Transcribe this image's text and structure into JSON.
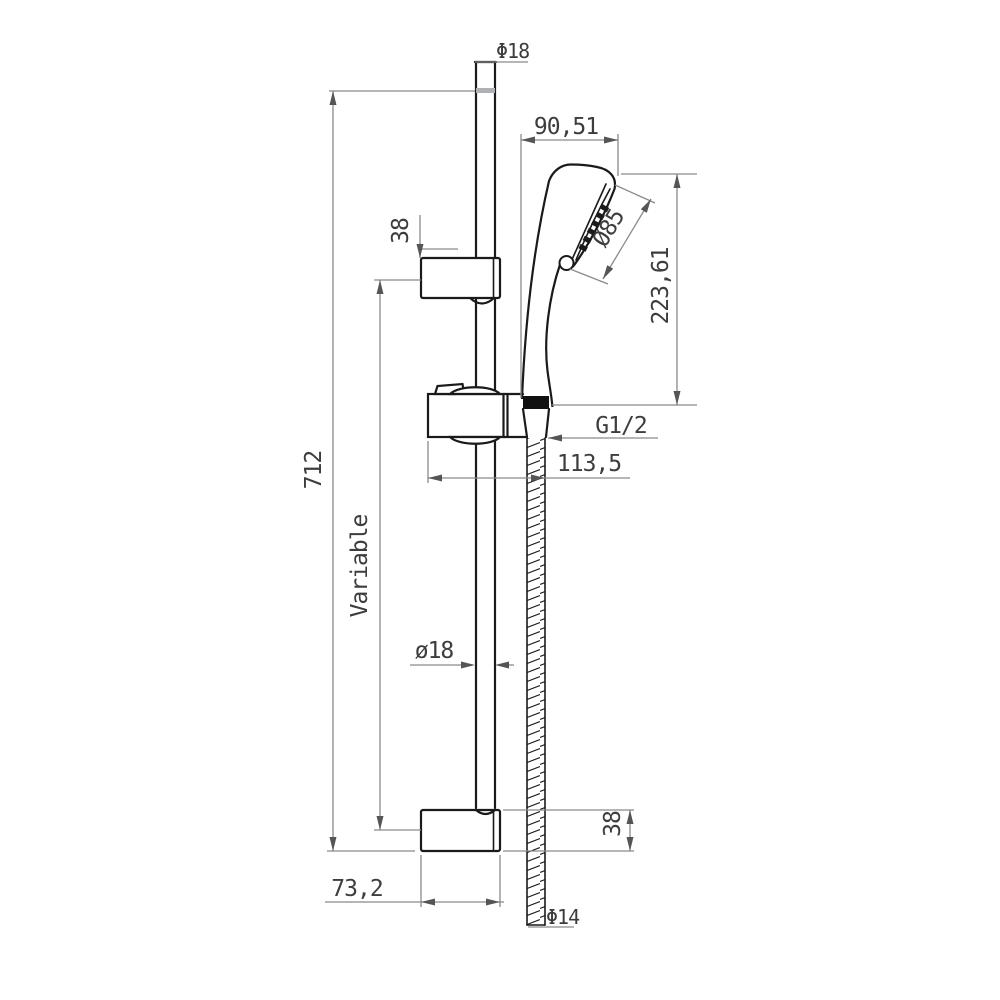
{
  "drawing": {
    "type": "technical-dimension-drawing",
    "subject": "shower slide bar set with hand shower and hose",
    "labels": {
      "top_bar_diameter": "Φ18",
      "head_reach": "90,51",
      "head_diameter": "Ø85",
      "head_height": "223,61",
      "top_bracket_depth": "38",
      "total_length": "712",
      "variable_span": "Variable",
      "thread_size": "G1/2",
      "holder_reach": "113,5",
      "bar_diameter": "ø18",
      "bottom_bracket_depth": "38",
      "bracket_width": "73,2",
      "hose_diameter": "Φ14"
    },
    "colors": {
      "background": "#ffffff",
      "part_outline": "#1a1a1a",
      "dimension_line": "#8a8a8a",
      "dimension_text": "#3d3d3d",
      "nut_fill": "#111111",
      "bar_cap_band": "#aeb2b6"
    }
  }
}
